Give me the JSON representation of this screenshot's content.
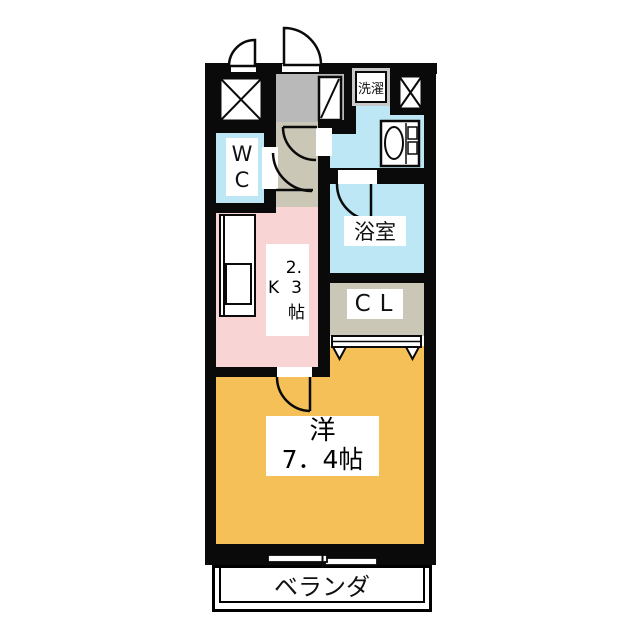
{
  "plan": {
    "wc_label": "WC",
    "laundry_label": "洗濯",
    "bathroom_label": "浴室",
    "closet_label": "CL",
    "kitchen": {
      "digit_top": "2.",
      "letter": "K",
      "digit_bottom": "3",
      "unit": "帖"
    },
    "main_room": {
      "name": "洋",
      "size": "7．4帖"
    },
    "veranda_label": "ベランダ"
  },
  "colors": {
    "wall": "#0a0a0a",
    "water_rooms_blue": "#bde7f5",
    "kitchen_pink": "#f8d4d4",
    "main_room_orange": "#f5c058",
    "entrance_gray": "#b9b9b9",
    "hallway_beige": "#cbc7b7",
    "laundry_frame_silver": "#c9c9c9"
  }
}
